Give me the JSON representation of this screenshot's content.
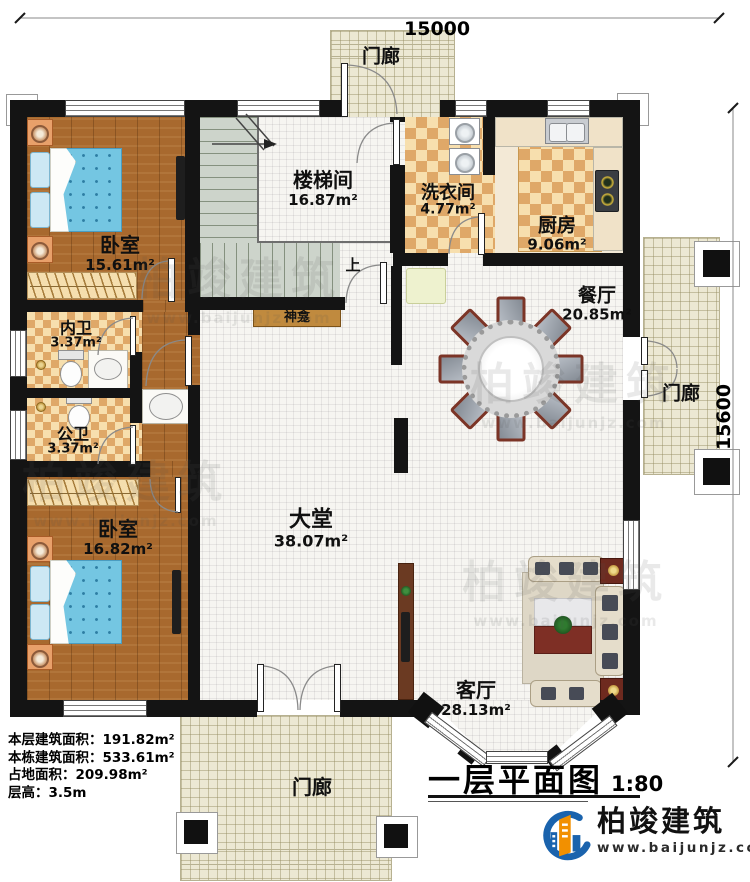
{
  "dimensions": {
    "top": "15000",
    "right": "15600"
  },
  "porches": {
    "top": "门廊",
    "right": "门廊",
    "bottom": "门廊"
  },
  "rooms": {
    "bedroom1": {
      "name": "卧室",
      "area": "15.61m²"
    },
    "stairwell": {
      "name": "楼梯间",
      "area": "16.87m²"
    },
    "laundry": {
      "name": "洗衣间",
      "area": "4.77m²"
    },
    "kitchen": {
      "name": "厨房",
      "area": "9.06m²"
    },
    "dining": {
      "name": "餐厅",
      "area": "20.85m²"
    },
    "bath_inner": {
      "name": "内卫",
      "area": "3.37m²"
    },
    "bath_public": {
      "name": "公卫",
      "area": "3.37m²"
    },
    "bedroom2": {
      "name": "卧室",
      "area": "16.82m²"
    },
    "hall": {
      "name": "大堂",
      "area": "38.07m²"
    },
    "living": {
      "name": "客厅",
      "area": "28.13m²"
    }
  },
  "annotations": {
    "shrine": "神龛",
    "stairs_up": "上"
  },
  "info_block": {
    "floor_area_label": "本层建筑面积：",
    "floor_area_value": "191.82m²",
    "building_area_label": "本栋建筑面积：",
    "building_area_value": "533.61m²",
    "land_area_label": "占地面积：",
    "land_area_value": "209.98m²",
    "floor_height_label": "层高：",
    "floor_height_value": "3.5m"
  },
  "title_block": {
    "title": "一层平面图",
    "scale": "1:80"
  },
  "logo": {
    "company": "柏竣建筑",
    "website": "www.baijunjz.com"
  },
  "watermark": {
    "text": "柏竣建筑",
    "url": "www.baijunjz.com"
  },
  "colors": {
    "wall": "#141414",
    "wood_floor": "#a8692e",
    "checker_tile": "#dfa868",
    "porch_tile": "#ece8d3",
    "stair_gray": "#cdd4cb",
    "bed_blue": "#74c6e2",
    "shrine_wood": "#c08a3e",
    "logo_blue": "#1a63ad",
    "logo_orange": "#f29000"
  }
}
